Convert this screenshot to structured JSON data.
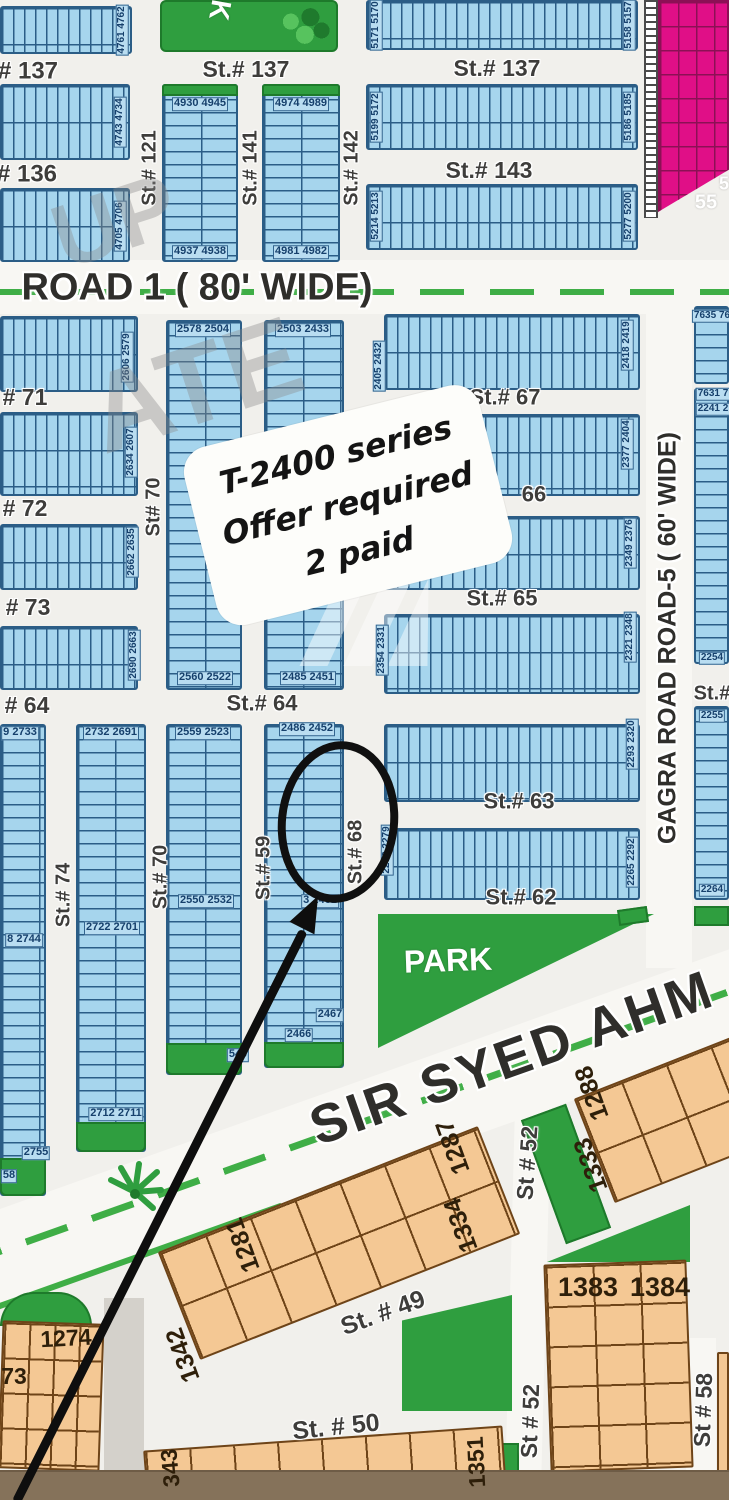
{
  "map_type": "housing scheme plot map",
  "note": {
    "lines": [
      "T-2400 series",
      "Offer required",
      "2 paid"
    ]
  },
  "roads": {
    "road1": "ROAD 1 ( 80' WIDE)",
    "gagra": "GAGRA ROAD ROAD-5 ( 60' WIDE)",
    "sir_syed": "SIR SYED AHM",
    "park": "PARK"
  },
  "colors": {
    "plot_blue": "#a6d5ed",
    "grid_navy": "#2b5d86",
    "park_green": "#2f9e3f",
    "commercial_pink": "#e00f87",
    "plot_orange": "#f4c894",
    "median_green": "#3fae46",
    "annotation_black": "#0e0e0e"
  },
  "labels": [
    {
      "t": "# 137",
      "cx": 28,
      "cy": 71,
      "cls": "street",
      "fs": 24
    },
    {
      "t": "St.# 137",
      "cx": 246,
      "cy": 69,
      "cls": "street",
      "fs": 23
    },
    {
      "t": "St.# 137",
      "cx": 497,
      "cy": 68,
      "cls": "street",
      "fs": 23
    },
    {
      "t": "# 136",
      "cx": 27,
      "cy": 174,
      "cls": "street",
      "fs": 24
    },
    {
      "t": "St.# 143",
      "cx": 489,
      "cy": 170,
      "cls": "street",
      "fs": 23
    },
    {
      "t": "St.# 121",
      "cx": 150,
      "cy": 168,
      "rot": -90,
      "cls": "street",
      "fs": 20
    },
    {
      "t": "St.# 141",
      "cx": 251,
      "cy": 168,
      "rot": -90,
      "cls": "street",
      "fs": 20
    },
    {
      "t": "St.# 142",
      "cx": 352,
      "cy": 168,
      "rot": -90,
      "cls": "street",
      "fs": 20
    },
    {
      "t": "K",
      "cx": 220,
      "cy": 10,
      "rot": 100,
      "cls": "white",
      "fs": 28
    },
    {
      "t": "4761 4762",
      "cx": 122,
      "cy": 30,
      "rot": -90,
      "cls": "chip",
      "fs": 10
    },
    {
      "t": "4743 4734",
      "cx": 120,
      "cy": 122,
      "rot": -90,
      "cls": "chip",
      "fs": 10
    },
    {
      "t": "4705 4706",
      "cx": 120,
      "cy": 226,
      "rot": -90,
      "cls": "chip",
      "fs": 10
    },
    {
      "t": "4930 4945",
      "cx": 200,
      "cy": 104,
      "cls": "chip",
      "fs": 11
    },
    {
      "t": "4937 4938",
      "cx": 200,
      "cy": 252,
      "cls": "chip",
      "fs": 11
    },
    {
      "t": "4974 4989",
      "cx": 301,
      "cy": 104,
      "cls": "chip",
      "fs": 11
    },
    {
      "t": "4981 4982",
      "cx": 301,
      "cy": 252,
      "cls": "chip",
      "fs": 11
    },
    {
      "t": "5171 5170",
      "cx": 376,
      "cy": 25,
      "rot": -90,
      "cls": "chip",
      "fs": 10
    },
    {
      "t": "5158 5157",
      "cx": 629,
      "cy": 25,
      "rot": -90,
      "cls": "chip",
      "fs": 10
    },
    {
      "t": "5199 5172",
      "cx": 376,
      "cy": 117,
      "rot": -90,
      "cls": "chip",
      "fs": 10
    },
    {
      "t": "5186 5185",
      "cx": 629,
      "cy": 117,
      "rot": -90,
      "cls": "chip",
      "fs": 10
    },
    {
      "t": "5214 5213",
      "cx": 376,
      "cy": 216,
      "rot": -90,
      "cls": "chip",
      "fs": 10
    },
    {
      "t": "5277 5200",
      "cx": 629,
      "cy": 216,
      "rot": -90,
      "cls": "chip",
      "fs": 10
    },
    {
      "t": "55",
      "cx": 706,
      "cy": 203,
      "cls": "white",
      "fs": 20
    },
    {
      "t": "5",
      "cx": 724,
      "cy": 184,
      "cls": "white",
      "fs": 18
    },
    {
      "t": "# 71",
      "cx": 25,
      "cy": 397,
      "cls": "street",
      "fs": 23
    },
    {
      "t": "# 72",
      "cx": 25,
      "cy": 508,
      "cls": "street",
      "fs": 23
    },
    {
      "t": "# 73",
      "cx": 28,
      "cy": 607,
      "cls": "street",
      "fs": 23
    },
    {
      "t": "# 64",
      "cx": 27,
      "cy": 705,
      "cls": "street",
      "fs": 23
    },
    {
      "t": "St# 70",
      "cx": 154,
      "cy": 507,
      "rot": -90,
      "cls": "street",
      "fs": 20
    },
    {
      "t": "2606 2579",
      "cx": 127,
      "cy": 357,
      "rot": -90,
      "cls": "chip",
      "fs": 10
    },
    {
      "t": "2634 2607",
      "cx": 131,
      "cy": 452,
      "rot": -90,
      "cls": "chip",
      "fs": 10
    },
    {
      "t": "2662 2635",
      "cx": 132,
      "cy": 552,
      "rot": -90,
      "cls": "chip",
      "fs": 10
    },
    {
      "t": "2690 2663",
      "cx": 134,
      "cy": 655,
      "rot": -90,
      "cls": "chip",
      "fs": 10
    },
    {
      "t": "2578 2504",
      "cx": 203,
      "cy": 330,
      "cls": "chip",
      "fs": 11
    },
    {
      "t": "2503 2433",
      "cx": 303,
      "cy": 330,
      "cls": "chip",
      "fs": 11
    },
    {
      "t": "2560 2522",
      "cx": 205,
      "cy": 678,
      "cls": "chip",
      "fs": 11
    },
    {
      "t": "2485 2451",
      "cx": 308,
      "cy": 678,
      "cls": "chip",
      "fs": 11
    },
    {
      "t": "2405 2432",
      "cx": 379,
      "cy": 366,
      "rot": -90,
      "cls": "chip",
      "fs": 10
    },
    {
      "t": "2418 2419",
      "cx": 627,
      "cy": 345,
      "rot": -90,
      "cls": "chip",
      "fs": 10
    },
    {
      "t": "St.# 67",
      "cx": 505,
      "cy": 397,
      "cls": "street",
      "fs": 22
    },
    {
      "t": "2377 2404",
      "cx": 627,
      "cy": 444,
      "rot": -90,
      "cls": "chip",
      "fs": 10
    },
    {
      "t": "66",
      "cx": 534,
      "cy": 494,
      "cls": "street",
      "fs": 22
    },
    {
      "t": "2349 2376",
      "cx": 630,
      "cy": 543,
      "rot": -90,
      "cls": "chip",
      "fs": 10
    },
    {
      "t": "St.# 65",
      "cx": 502,
      "cy": 598,
      "cls": "street",
      "fs": 22
    },
    {
      "t": "2354 2331",
      "cx": 382,
      "cy": 650,
      "rot": -90,
      "cls": "chip",
      "fs": 10
    },
    {
      "t": "2321 2348",
      "cx": 630,
      "cy": 637,
      "rot": -90,
      "cls": "chip",
      "fs": 10
    },
    {
      "t": "St.# 64",
      "cx": 262,
      "cy": 703,
      "cls": "street",
      "fs": 22
    },
    {
      "t": "St.#",
      "cx": 712,
      "cy": 694,
      "cls": "street",
      "fs": 20
    },
    {
      "t": "2293 2320",
      "cx": 632,
      "cy": 744,
      "rot": -90,
      "cls": "chip",
      "fs": 10
    },
    {
      "t": "St.# 63",
      "cx": 519,
      "cy": 801,
      "cls": "street",
      "fs": 22
    },
    {
      "t": "2278 2279",
      "cx": 387,
      "cy": 850,
      "rot": -90,
      "cls": "chip",
      "fs": 10
    },
    {
      "t": "2265 2292",
      "cx": 632,
      "cy": 862,
      "rot": -90,
      "cls": "chip",
      "fs": 10
    },
    {
      "t": "St.# 62",
      "cx": 521,
      "cy": 897,
      "cls": "street",
      "fs": 22
    },
    {
      "t": "7635 76",
      "cx": 712,
      "cy": 316,
      "cls": "chip",
      "fs": 10
    },
    {
      "t": "7631 7",
      "cx": 713,
      "cy": 394,
      "cls": "chip",
      "fs": 10
    },
    {
      "t": "2241 2",
      "cx": 713,
      "cy": 409,
      "cls": "chip",
      "fs": 10
    },
    {
      "t": "2254",
      "cx": 712,
      "cy": 658,
      "cls": "chip",
      "fs": 10
    },
    {
      "t": "2255",
      "cx": 712,
      "cy": 716,
      "cls": "chip",
      "fs": 10
    },
    {
      "t": "2264",
      "cx": 712,
      "cy": 890,
      "cls": "chip",
      "fs": 10
    },
    {
      "t": "9 2733",
      "cx": 20,
      "cy": 733,
      "cls": "chip",
      "fs": 11
    },
    {
      "t": "2732 2691",
      "cx": 111,
      "cy": 733,
      "cls": "chip",
      "fs": 11
    },
    {
      "t": "2559 2523",
      "cx": 203,
      "cy": 733,
      "cls": "chip",
      "fs": 11
    },
    {
      "t": "2486 2452",
      "cx": 307,
      "cy": 729,
      "cls": "chip",
      "fs": 11
    },
    {
      "t": "2550 2532",
      "cx": 206,
      "cy": 901,
      "cls": "chip",
      "fs": 11
    },
    {
      "t": "3 2461",
      "cx": 320,
      "cy": 901,
      "cls": "chip",
      "fs": 11
    },
    {
      "t": "2722 2701",
      "cx": 112,
      "cy": 928,
      "cls": "chip",
      "fs": 11
    },
    {
      "t": "8 2744",
      "cx": 24,
      "cy": 940,
      "cls": "chip",
      "fs": 11
    },
    {
      "t": "St.# 74",
      "cx": 64,
      "cy": 895,
      "rot": -90,
      "cls": "street",
      "fs": 20
    },
    {
      "t": "St.# 70",
      "cx": 161,
      "cy": 877,
      "rot": -90,
      "cls": "street",
      "fs": 20
    },
    {
      "t": "St.# 59",
      "cx": 264,
      "cy": 868,
      "rot": -90,
      "cls": "street",
      "fs": 20
    },
    {
      "t": "St.# 68",
      "cx": 356,
      "cy": 852,
      "rot": -90,
      "cls": "street",
      "fs": 20
    },
    {
      "t": "2712 2711",
      "cx": 116,
      "cy": 1114,
      "cls": "chip",
      "fs": 11
    },
    {
      "t": "2755",
      "cx": 36,
      "cy": 1153,
      "cls": "chip",
      "fs": 11
    },
    {
      "t": "58",
      "cx": 9,
      "cy": 1176,
      "cls": "chip",
      "fs": 11
    },
    {
      "t": "2467",
      "cx": 330,
      "cy": 1015,
      "cls": "chip",
      "fs": 11
    },
    {
      "t": "2466",
      "cx": 299,
      "cy": 1035,
      "cls": "chip",
      "fs": 11
    },
    {
      "t": "540",
      "cx": 238,
      "cy": 1055,
      "cls": "chip",
      "fs": 11
    },
    {
      "t": "PARK",
      "cx": 448,
      "cy": 961,
      "rot": -2,
      "cls": "white",
      "fs": 32
    },
    {
      "t": "St. # 49",
      "cx": 383,
      "cy": 1313,
      "rot": -20,
      "cls": "street",
      "fs": 25
    },
    {
      "t": "St. # 50",
      "cx": 336,
      "cy": 1427,
      "rot": -6,
      "cls": "street",
      "fs": 25
    },
    {
      "t": "St # 52",
      "cx": 527,
      "cy": 1163,
      "rot": -86,
      "cls": "street",
      "fs": 23
    },
    {
      "t": "St # 52",
      "cx": 530,
      "cy": 1421,
      "rot": -88,
      "cls": "street",
      "fs": 23
    },
    {
      "t": "St # 58",
      "cx": 703,
      "cy": 1410,
      "rot": -88,
      "cls": "street",
      "fs": 23
    },
    {
      "t": "1281",
      "cx": 243,
      "cy": 1245,
      "rot": -110,
      "cls": "chipO",
      "fs": 25
    },
    {
      "t": "1287",
      "cx": 453,
      "cy": 1147,
      "rot": -110,
      "cls": "chipO",
      "fs": 25
    },
    {
      "t": "1334",
      "cx": 461,
      "cy": 1225,
      "rot": -110,
      "cls": "chipO",
      "fs": 25
    },
    {
      "t": "1342",
      "cx": 183,
      "cy": 1355,
      "rot": -110,
      "cls": "chipO",
      "fs": 25
    },
    {
      "t": "1288",
      "cx": 592,
      "cy": 1093,
      "rot": -110,
      "cls": "chipO",
      "fs": 25
    },
    {
      "t": "1333",
      "cx": 591,
      "cy": 1165,
      "rot": -110,
      "cls": "chipO",
      "fs": 25
    },
    {
      "t": "1383",
      "cx": 588,
      "cy": 1287,
      "cls": "chipO",
      "fs": 27
    },
    {
      "t": "1384",
      "cx": 660,
      "cy": 1287,
      "cls": "chipO",
      "fs": 27
    },
    {
      "t": "1274",
      "cx": 66,
      "cy": 1338,
      "rot": -3,
      "cls": "chipO",
      "fs": 23
    },
    {
      "t": "73",
      "cx": 14,
      "cy": 1376,
      "cls": "chipO",
      "fs": 23
    },
    {
      "t": "343",
      "cx": 170,
      "cy": 1468,
      "rot": -95,
      "cls": "chipO",
      "fs": 23
    },
    {
      "t": "1351",
      "cx": 476,
      "cy": 1462,
      "rot": -93,
      "cls": "chipO",
      "fs": 23
    },
    {
      "t": "UP",
      "cx": 115,
      "cy": 222,
      "rot": -18,
      "cls": "wm",
      "fs": 90
    },
    {
      "t": "ATE",
      "cx": 195,
      "cy": 385,
      "rot": -18,
      "cls": "wm",
      "fs": 112
    }
  ]
}
